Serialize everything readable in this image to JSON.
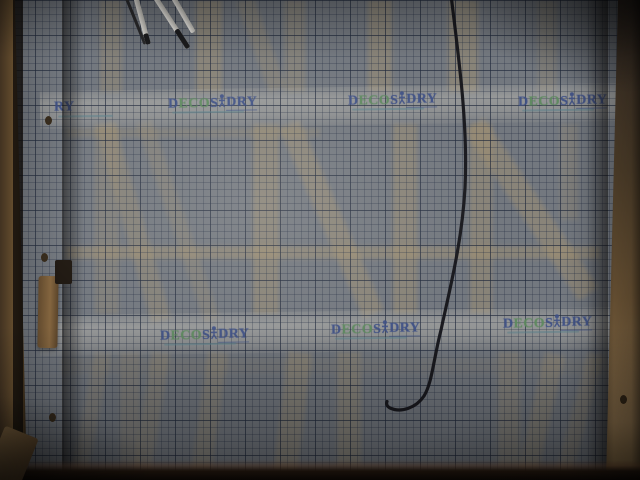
{
  "logo": {
    "d": "D",
    "eco": "ECO",
    "s": "S",
    "dry": "DRY",
    "partial": "RY"
  },
  "colors": {
    "logo_navy": "#3e5086",
    "logo_green": "#5d8a5e",
    "sheet_base": "#73787f",
    "grid_line": "#232d42",
    "band_light": "#b6b1a6",
    "wood_front": "#a08050",
    "wood_behind": "#9a8a6d",
    "cable": "#15151a",
    "rod_light": "#d6d4d0",
    "floor_dark": "#1a120c"
  }
}
